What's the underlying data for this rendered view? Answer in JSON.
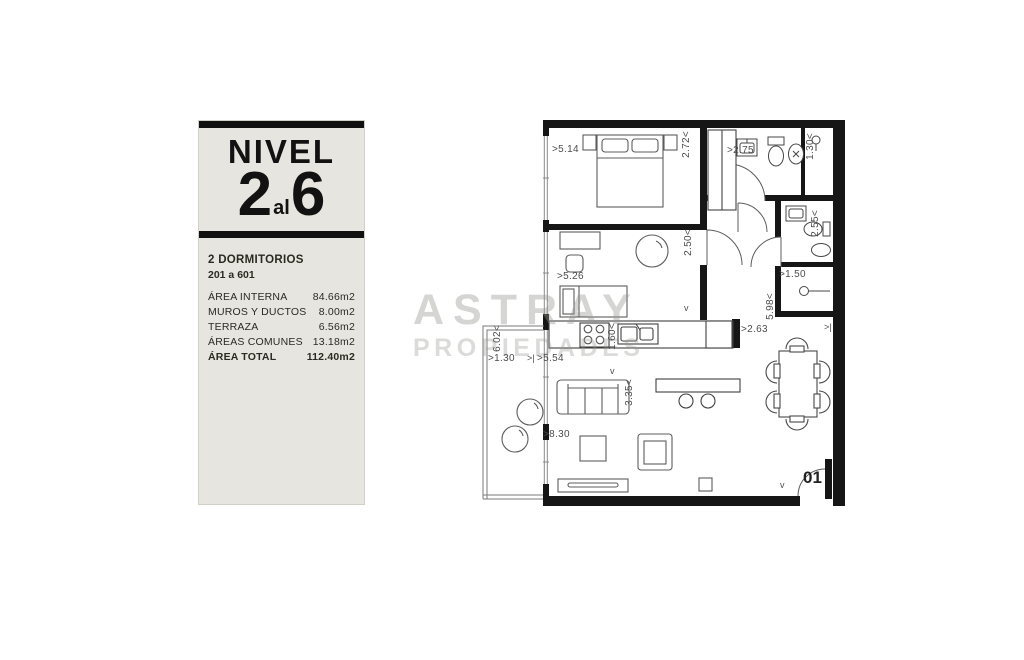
{
  "panel": {
    "level_label": "NIVEL",
    "level_from": "2",
    "level_connector": "al",
    "level_to": "6",
    "type_label": "2 DORMITORIOS",
    "units_range": "201 a 601",
    "area_rows": [
      {
        "label": "ÁREA INTERNA",
        "value": "84.66m2"
      },
      {
        "label": "MUROS Y DUCTOS",
        "value": "8.00m2"
      },
      {
        "label": "TERRAZA",
        "value": "6.56m2"
      },
      {
        "label": "ÁREAS COMUNES",
        "value": "13.18m2"
      }
    ],
    "total": {
      "label": "ÁREA TOTAL",
      "value": "112.40m2"
    }
  },
  "watermark": {
    "line1": "ASTRAY",
    "line2": "PROPIEDADES"
  },
  "plan": {
    "unit_number": "01",
    "colors": {
      "wall": "#161616",
      "furniture_line": "#5c5c5c",
      "panel_bg": "#e6e5df"
    },
    "dims": [
      {
        "text": ">5.14"
      },
      {
        "text": "2.72<"
      },
      {
        "text": ">2.75"
      },
      {
        "text": "1.30<"
      },
      {
        "text": "2.55<"
      },
      {
        "text": ">1.50"
      },
      {
        "text": "5.98<"
      },
      {
        "text": ">5.26"
      },
      {
        "text": "2.50<"
      },
      {
        "text": "1.60<"
      },
      {
        "text": ">2.63"
      },
      {
        "text": "6.02<"
      },
      {
        "text": ">1.30"
      },
      {
        "text": ">5.54"
      },
      {
        "text": "3.35<"
      },
      {
        "text": ">8.30"
      }
    ],
    "marks": [
      {
        "text": "v"
      },
      {
        "text": ">|"
      },
      {
        "text": "v"
      },
      {
        "text": "v"
      },
      {
        "text": ">|"
      }
    ]
  }
}
